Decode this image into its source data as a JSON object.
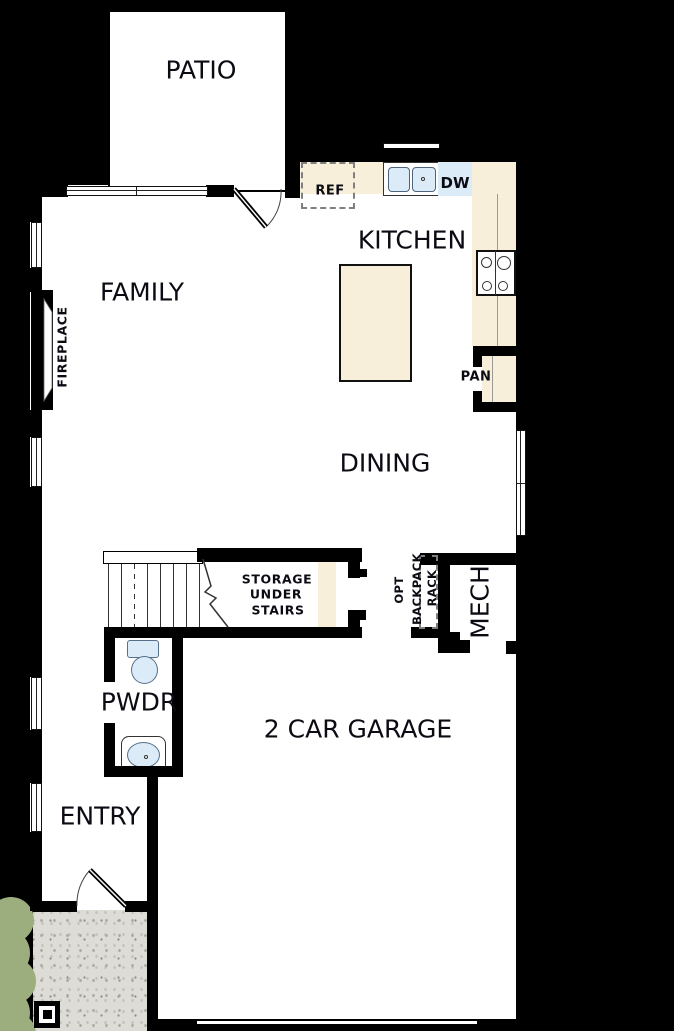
{
  "plan": {
    "rooms": {
      "patio": "PATIO",
      "kitchen": "KITCHEN",
      "family": "FAMILY",
      "dining": "DINING",
      "garage": "2 CAR GARAGE",
      "powder": "PWDR",
      "entry": "ENTRY",
      "mech": "MECH"
    },
    "fixtures": {
      "fridge": "REF",
      "dishwasher": "DW",
      "pantry": "PAN",
      "fireplace": "FIREPLACE"
    },
    "storage_note": {
      "line1": "STORAGE",
      "line2": "UNDER",
      "line3": "STAIRS"
    },
    "backpack_note": {
      "line1": "OPT",
      "line2": "BACKPACK",
      "line3": "RACK"
    },
    "colors": {
      "background": "#000000",
      "walls": "#000000",
      "floor": "#ffffff",
      "counters": "#f7efda",
      "fixtures_blue": "#dcebf8",
      "porch_concrete": "#dedcd6",
      "shrub_green": "#9cad7e"
    }
  }
}
